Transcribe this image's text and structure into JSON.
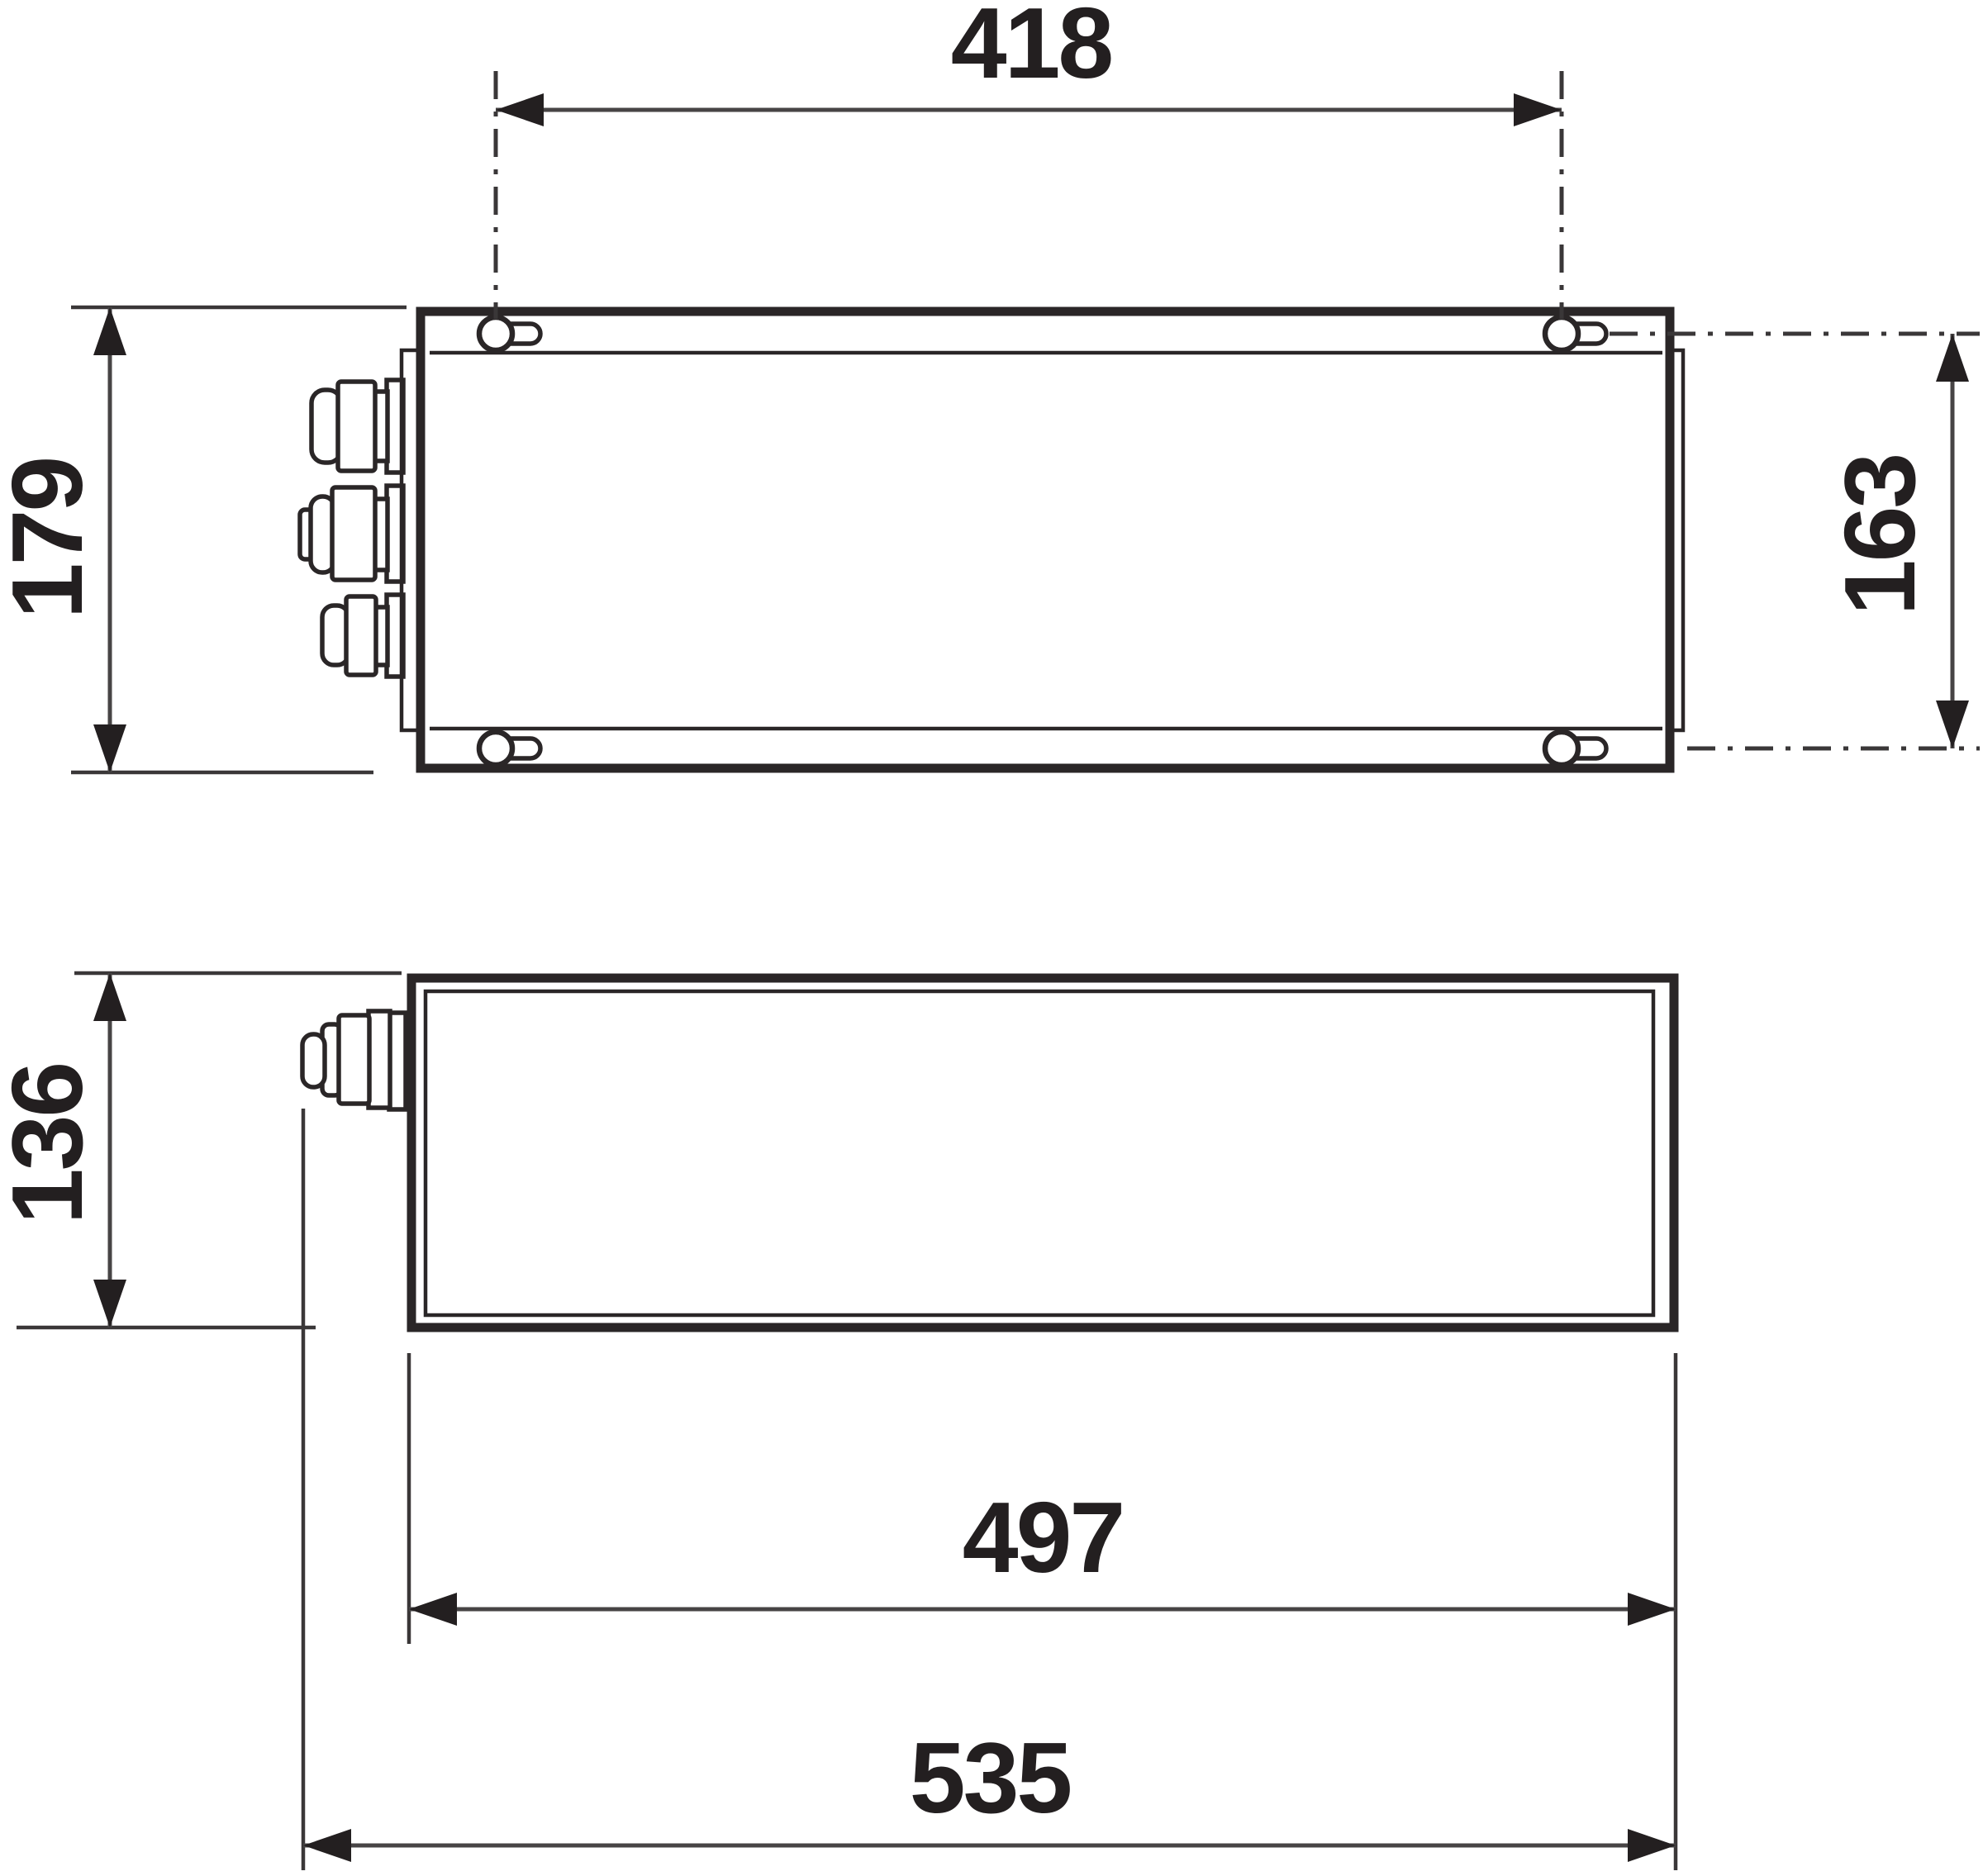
{
  "drawing": {
    "kind": "technical-dimension-drawing",
    "views": {
      "top_view": "enclosure seen from above with mounting flanges, four keyhole slots and three cable glands on the left side",
      "side_view": "enclosure seen from the side with one cable gland on the left"
    },
    "dims": {
      "mounting_pitch_length": "418",
      "depth_overall": "179",
      "mounting_pitch_depth": "163",
      "height_overall": "136",
      "body_length": "497",
      "length_overall": "535"
    }
  },
  "colors": {
    "line": "#2a2627",
    "dimension_line": "#474445",
    "text": "#231f20",
    "background": "#ffffff"
  }
}
